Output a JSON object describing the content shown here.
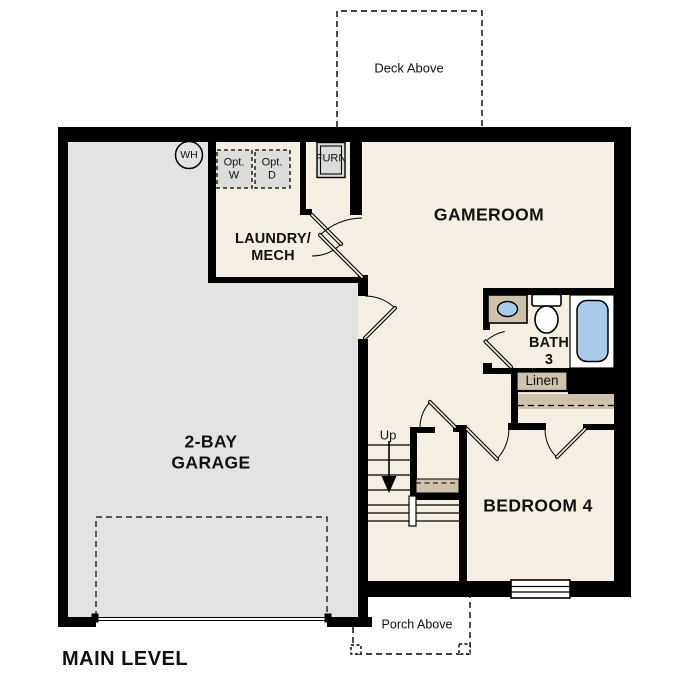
{
  "title": "MAIN LEVEL",
  "colors": {
    "wall": "#000000",
    "floor": "#f5eee2",
    "garage": "#e3e3e1",
    "tan": "#cec2ac",
    "blue": "#a9cbe9",
    "appliance": "#dcdcda",
    "ink": "#111111"
  },
  "outdoor": {
    "deck_label": "Deck Above",
    "porch_label": "Porch Above"
  },
  "rooms": {
    "garage": {
      "name_line1": "2-BAY",
      "name_line2": "GARAGE"
    },
    "laundry": {
      "name_line1": "LAUNDRY/",
      "name_line2": "MECH"
    },
    "gameroom": {
      "name": "GAMEROOM"
    },
    "bath": {
      "name_line1": "BATH",
      "name_line2": "3"
    },
    "bedroom": {
      "name": "BEDROOM 4"
    },
    "linen_closet": {
      "name": "Linen"
    }
  },
  "equipment": {
    "water_heater": "WH",
    "furnace": "FURN",
    "washer_line1": "Opt.",
    "washer_line2": "W",
    "dryer_line1": "Opt.",
    "dryer_line2": "D"
  },
  "stairs": {
    "direction_label": "Up"
  }
}
